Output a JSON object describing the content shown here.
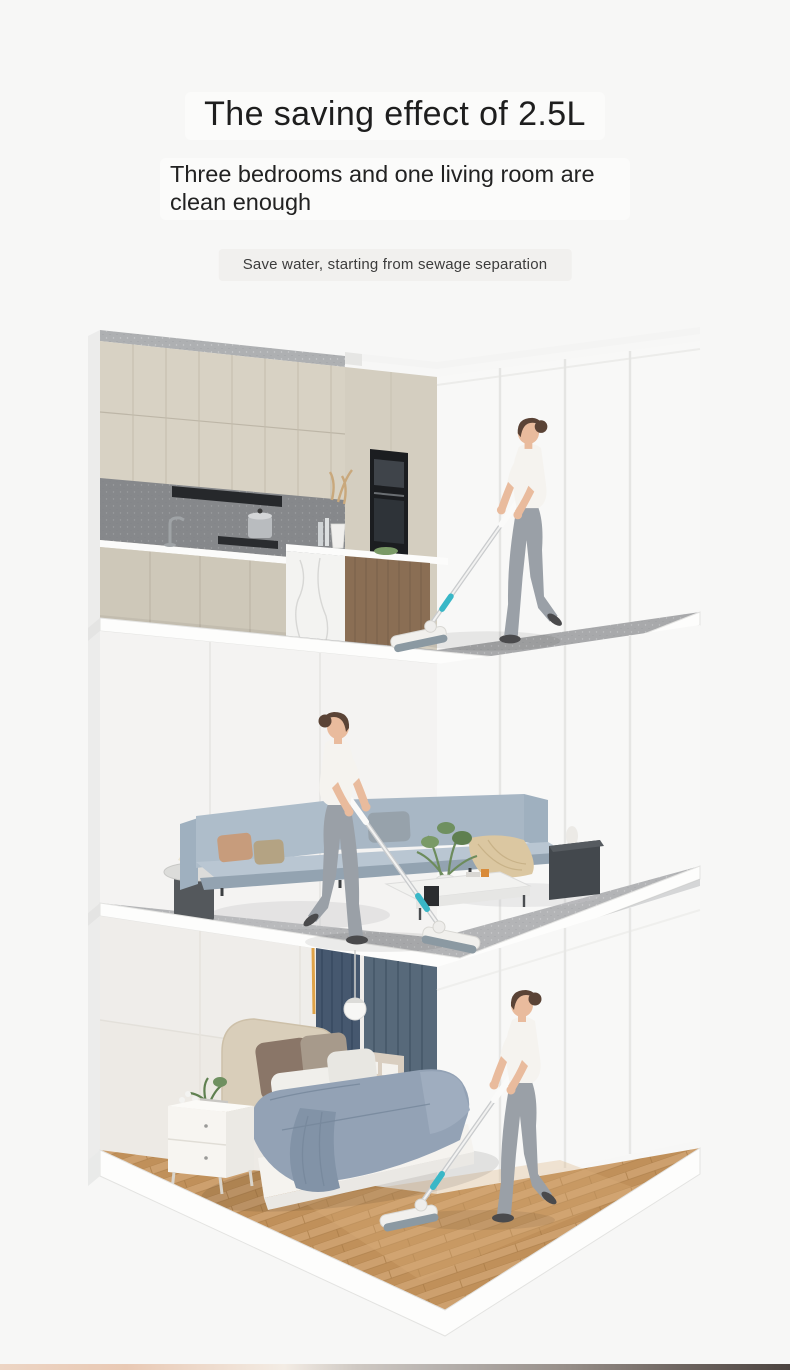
{
  "header": {
    "title": "The saving effect of 2.5L",
    "subtitle_line1": "Three bedrooms and one living room are",
    "subtitle_line2": "clean enough",
    "caption": "Save water, starting from sewage separation"
  },
  "colors": {
    "page": "#f7f7f6",
    "text": "#1e1e1e",
    "caption_bg": "#f1f0ee",
    "caption_text": "#3c3c3c",
    "wall": "#f8f8f7",
    "cabinet": "#d8d2c4",
    "concrete": "#aeb0b2",
    "kfloor": "#a8a9ab",
    "lfloor": "#b3b4b6",
    "wood": "#c79965",
    "sofa": "#aebdca",
    "curtain": "#46586f",
    "duvet": "#93a2b5",
    "headboard": "#d9ceba",
    "teal": "#39b7c7",
    "skin": "#e9bb9d",
    "leggings": "#9aa0a7",
    "shirt": "#f5f3ef",
    "strip_left": "#edd5c4",
    "strip_mid": "#b8b3af",
    "strip_right": "#4c4440"
  }
}
